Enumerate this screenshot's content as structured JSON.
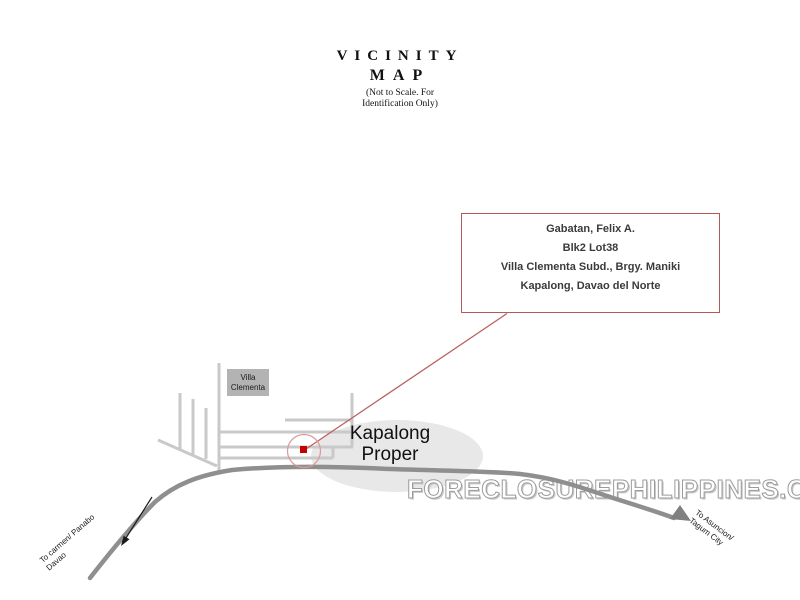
{
  "title": {
    "main_line1": "VICINITY",
    "main_line2": "MAP",
    "note_line1": "(Not to Scale. For",
    "note_line2": "Identification Only)"
  },
  "info_box": {
    "owner": "Gabatan, Felix A.",
    "lot": "Blk2 Lot38",
    "subdivision": "Villa Clementa Subd., Brgy. Maniki",
    "municipality": "Kapalong, Davao del Norte",
    "border_color": "#b05a5a",
    "text_color": "#3b3b3b"
  },
  "map_labels": {
    "villa_clementa": {
      "line1": "Villa",
      "line2": "Clementa",
      "bg_color": "#b3b3b3"
    },
    "kapalong_proper": {
      "line1": "Kapalong",
      "line2": "Proper"
    },
    "road_label_left": {
      "line1": "To carmen/ Panabo",
      "line2": "Davao"
    },
    "road_label_right": {
      "line1": "To Asuncion/",
      "line2": "Tagum City"
    }
  },
  "watermark": {
    "text": "FORECLOSUREPHILIPPINES.COM",
    "fill_color": "#ffffff",
    "outline_color": "#9c9c9c"
  },
  "map_colors": {
    "road": "#8f8f8f",
    "road_arrowhead": "#808080",
    "street": "#c9c9c9",
    "town_ellipse": "#e8e8e8",
    "marker_dot": "#c40000",
    "marker_circle": "#d89a9a",
    "pointer_line": "#bd5f5f",
    "direction_arrow": "#1a1a1a"
  }
}
